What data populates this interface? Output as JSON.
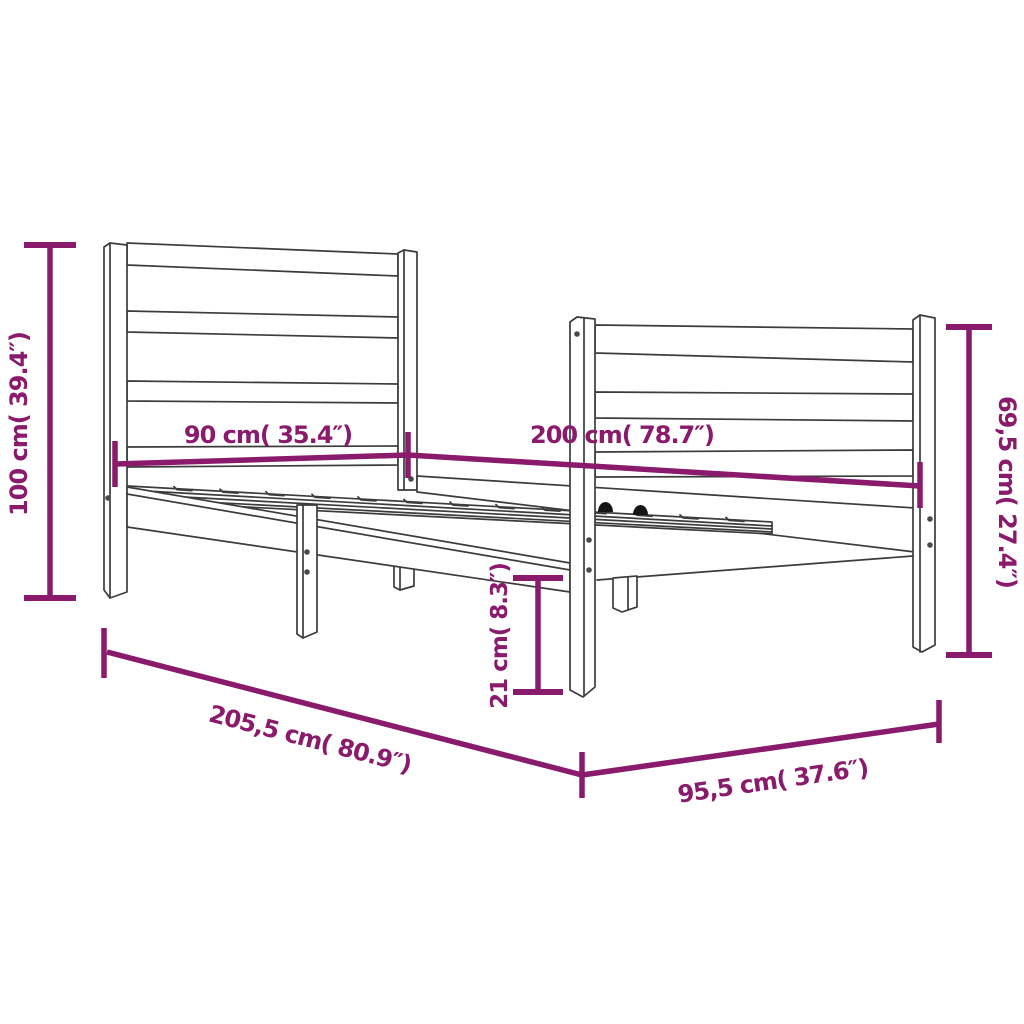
{
  "diagram": {
    "subject": "bed-frame",
    "colors": {
      "dimension": "#8A1A6B",
      "line_art": "#3C3C3C",
      "screw": "#4A4A4A",
      "bracket": "#151515",
      "background": "#FFFFFF"
    },
    "labels": {
      "total_height": "100 cm( 39.4″)",
      "headboard_width": "90 cm( 35.4″)",
      "bed_length": "200 cm( 78.7″)",
      "footboard_height": "69,5 cm( 27.4″)",
      "leg_height": "21 cm( 8.3″)",
      "total_length": "205,5 cm( 80.9″)",
      "total_width": "95,5 cm( 37.6″)"
    }
  }
}
